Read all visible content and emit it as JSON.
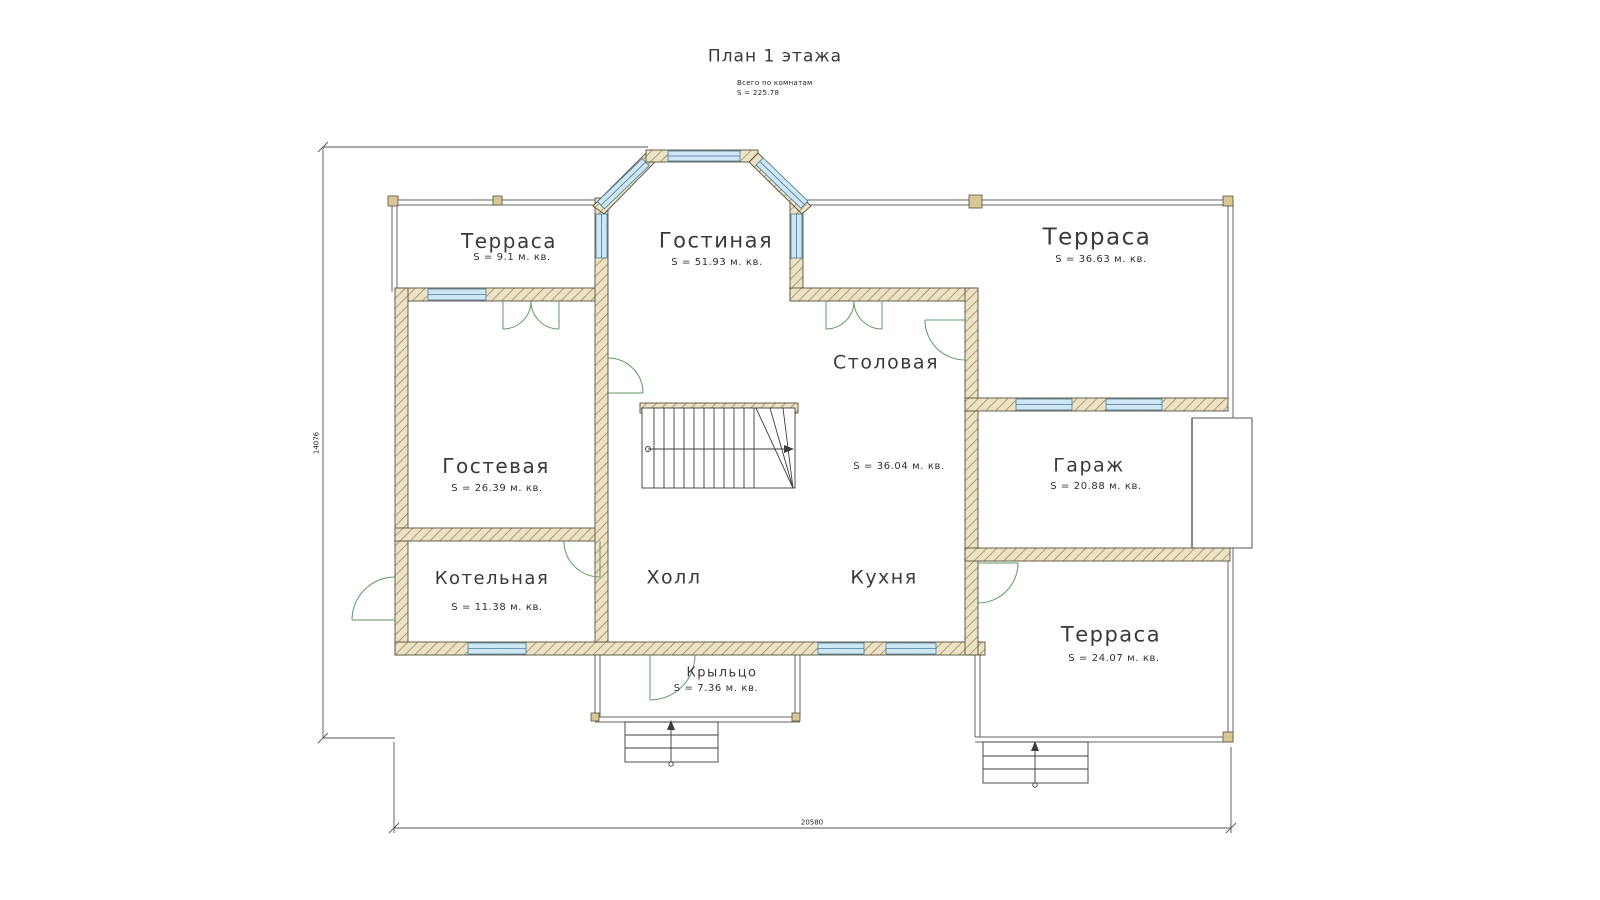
{
  "title": "План 1 этажа",
  "summary": {
    "caption": "Всего по комнатам",
    "total": "S  =  225.78"
  },
  "rooms": {
    "terrace_top_left": {
      "name": "Терраса",
      "area": "S  =  9.1 м. кв."
    },
    "living": {
      "name": "Гостиная",
      "area": "S  =  51.93 м. кв."
    },
    "terrace_top_right": {
      "name": "Терраса",
      "area": "S  =  36.63 м. кв."
    },
    "guest": {
      "name": "Гостевая",
      "area": "S  =  26.39 м. кв."
    },
    "dining": {
      "name": "Столовая",
      "area": "S  =  36.04 м. кв."
    },
    "garage": {
      "name": "Гараж",
      "area": "S  =  20.88 м. кв."
    },
    "boiler": {
      "name": "Котельная",
      "area": "S  =  11.38 м. кв."
    },
    "hall": {
      "name": "Холл"
    },
    "kitchen": {
      "name": "Кухня"
    },
    "terrace_bottom_right": {
      "name": "Терраса",
      "area": "S  =  24.07 м. кв."
    },
    "porch": {
      "name": "Крыльцо",
      "area": "S  =  7.36 м. кв."
    }
  },
  "dimensions": {
    "horizontal": "20580",
    "vertical": "14076"
  },
  "colors": {
    "wall_fill": "#ece3c6",
    "wall_hatch": "#9b8a5a",
    "wall_outline": "#55503c",
    "window": "#cfe6f4",
    "window_frame": "#4a7a9a",
    "door": "#5e9a5e",
    "line": "#555555"
  }
}
